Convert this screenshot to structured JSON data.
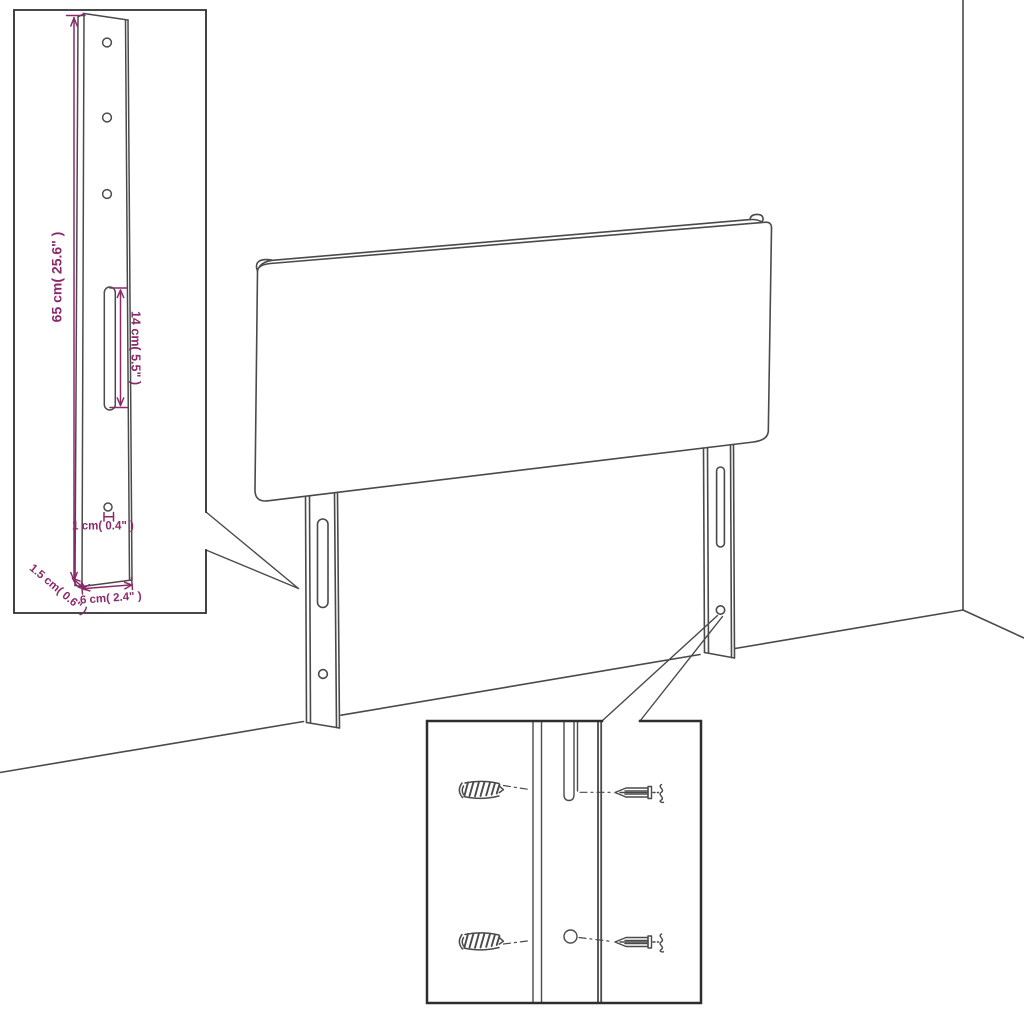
{
  "figure": {
    "description": "Line-art dimension diagram of an upholstered headboard with two slotted mounting legs standing against a room corner, with a magnified leg detail inset (top left) and a magnified keyhole-slot / screw mounting inset (bottom center)"
  },
  "dimension_labels": {
    "leg_height": "65 cm( 25.6\" )",
    "slot_length": "14 cm( 5.5\" )",
    "hole_diameter": "1 cm( 0.4\" )",
    "leg_depth": "1.5 cm( 0.6\" )",
    "leg_width": "6 cm( 2.4\" )"
  },
  "colors": {
    "line": "#4a4a4a",
    "inset_border": "#2e2e2e",
    "dimension": "#8b2a6b",
    "background": "#ffffff"
  }
}
